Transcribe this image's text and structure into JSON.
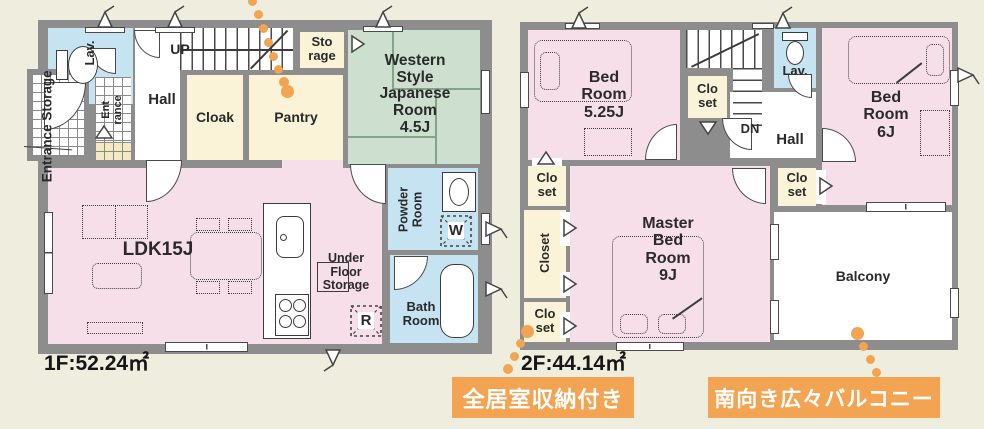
{
  "colors": {
    "background": "#efeede",
    "wall_gray": "#8d8d8d",
    "room_pink": "#f6dfe9",
    "room_cream": "#faf3d7",
    "room_blue": "#c6e3f1",
    "room_green": "#cde0cf",
    "accent_orange": "#f2a452"
  },
  "floor1": {
    "area": "1F:52.24㎡",
    "entrance_storage": "Entrance Storage",
    "lav": "Lav.",
    "up": "UP",
    "hall": "Hall",
    "storage": "Sto\nrage",
    "cloak": "Cloak",
    "pantry": "Pantry",
    "western_room": "Western\nStyle\nJapanese\nRoom\n4.5J",
    "entrance": "Ent\nrance",
    "ldk": "LDK15J",
    "under_floor_storage": "Under\nFloor\nStorage",
    "refrigerator": "R",
    "powder_room": "Powder\nRoom",
    "washer": "W",
    "bath_room": "Bath\nRoom"
  },
  "floor2": {
    "area": "2F:44.14㎡",
    "bedroom_525": "Bed\nRoom\n5.25J",
    "closet_small": "Clo\nset",
    "dn": "DN",
    "lav": "Lav.",
    "hall": "Hall",
    "bedroom_6": "Bed\nRoom\n6J",
    "master_bedroom": "Master\nBed\nRoom\n9J",
    "closet": "Closet",
    "balcony": "Balcony"
  },
  "badges": {
    "storage": "全居室収納付き",
    "balcony": "南向き広々バルコニー"
  }
}
